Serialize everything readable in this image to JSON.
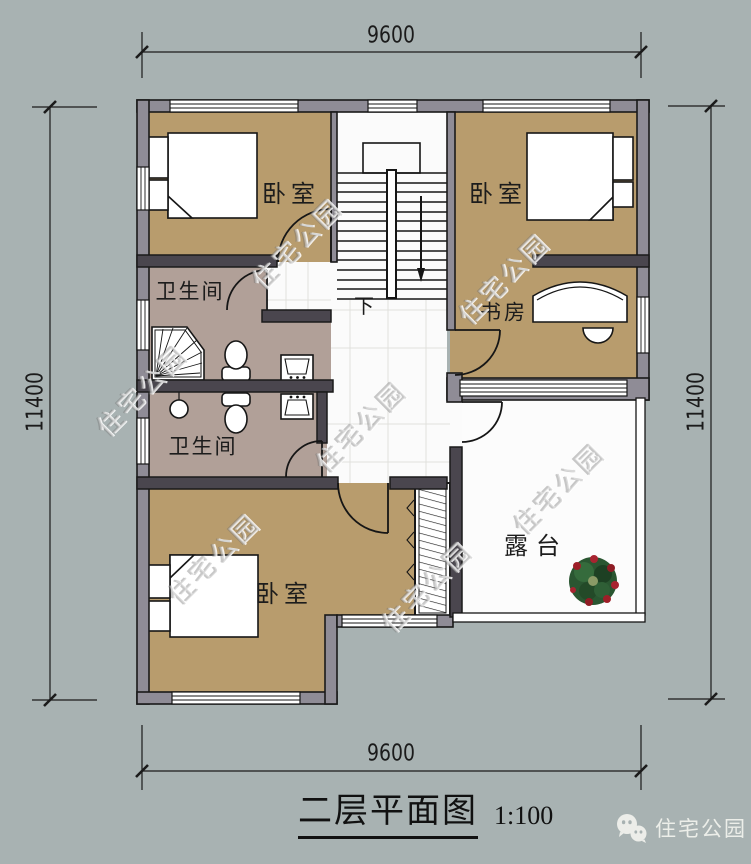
{
  "title": {
    "text": "二层平面图",
    "scale": "1:100"
  },
  "dimensions": {
    "top": "9600",
    "bottom": "9600",
    "left": "11400",
    "right": "11400"
  },
  "rooms": {
    "bedroom_top_left": "卧室",
    "bedroom_top_right": "卧室",
    "bathroom_upper": "卫生间",
    "bathroom_lower": "卫生间",
    "study": "书房",
    "bedroom_bottom": "卧室",
    "terrace": "露台",
    "stair_direction": "下"
  },
  "watermark": {
    "text": "住宅公园"
  },
  "logo": {
    "text": "住宅公园"
  },
  "colors": {
    "background": "#a8b2b2",
    "outer_wall_fill": "#8f8c96",
    "interior_wall_fill": "#4a464e",
    "wall_line": "#1a1a1a",
    "bedroom_floor": "#b89c6d",
    "bathroom_floor": "#b1a098",
    "hall_floor": "#fbfbfb",
    "terrace_floor": "#fcfcfc",
    "plant_green": "#2a5631",
    "plant_red": "#a02430",
    "dimension_line": "#1b1b1b",
    "title_color": "#111111"
  }
}
